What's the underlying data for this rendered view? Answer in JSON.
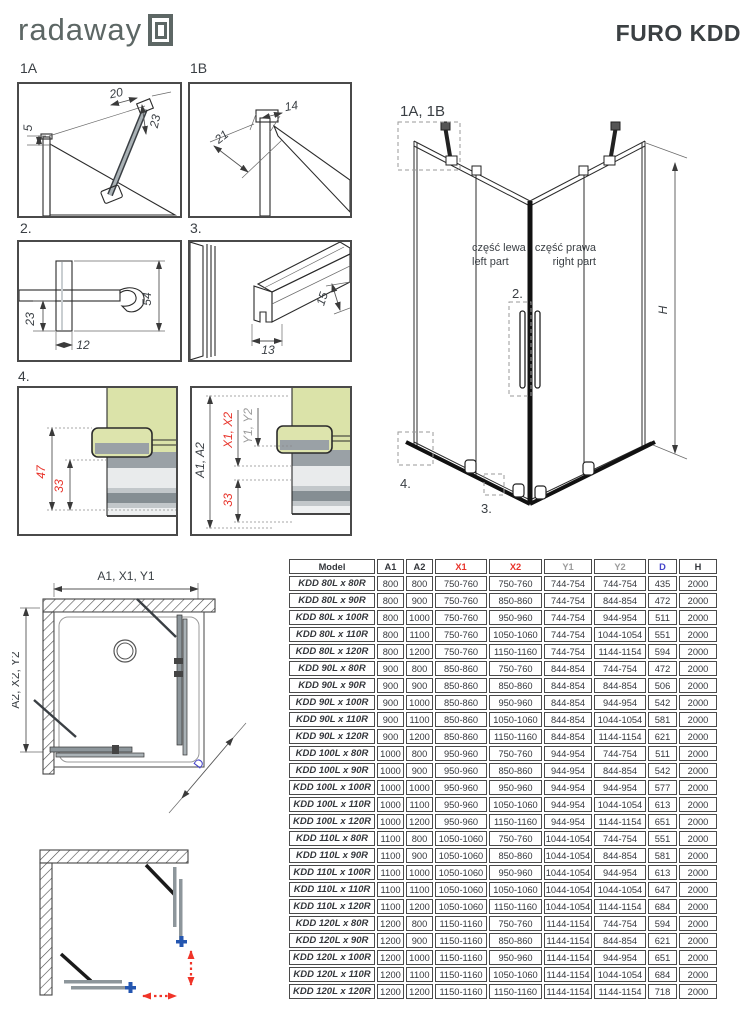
{
  "header": {
    "logo_text": "radaway",
    "title": "FURO KDD"
  },
  "details": {
    "d1a": {
      "label": "1A",
      "dim_top": "20",
      "dim_right": "23",
      "dim_left": "5"
    },
    "d1b": {
      "label": "1B",
      "dim_top": "14",
      "dim_diag": "21"
    },
    "d2": {
      "label": "2.",
      "dim_right": "54",
      "dim_left": "23",
      "dim_bottom": "12"
    },
    "d3": {
      "label": "3.",
      "dim_bottom": "13",
      "dim_right": "15"
    },
    "d4": {
      "label": "4.",
      "dim_outer": "47",
      "dim_inner": "33",
      "dim_a": "A1, A2",
      "dim_x": "X1, X2",
      "dim_y": "Y1, Y2",
      "dim_33": "33"
    }
  },
  "iso": {
    "callout_top": "1A, 1B",
    "callout_handle": "2.",
    "callout_rail": "3.",
    "callout_sill": "4.",
    "part_left_pl": "część lewa",
    "part_left_en": "left part",
    "part_right_pl": "część prawa",
    "part_right_en": "right part",
    "dim_h": "H"
  },
  "plan": {
    "dim_top_a": "A1, ",
    "dim_top_x": "X1, ",
    "dim_top_y": "Y1",
    "dim_left_a": "A2, ",
    "dim_left_x": "X2, ",
    "dim_left_y": "Y2",
    "dim_d": "D"
  },
  "colors": {
    "accent_red": "#e8332a",
    "dim_gray": "#9b9b9b",
    "dim_blue": "#4443c9",
    "text_dark": "#3a3f44",
    "logo_gray": "#5d6765"
  },
  "table": {
    "headers": [
      "Model",
      "A1",
      "A2",
      "X1",
      "X2",
      "Y1",
      "Y2",
      "D",
      "H"
    ],
    "header_colors": [
      "dark",
      "dark",
      "dark",
      "red",
      "red",
      "gray",
      "gray",
      "blue",
      "dark"
    ],
    "rows": [
      [
        "KDD 80L x 80R",
        "800",
        "800",
        "750-760",
        "750-760",
        "744-754",
        "744-754",
        "435",
        "2000"
      ],
      [
        "KDD 80L x 90R",
        "800",
        "900",
        "750-760",
        "850-860",
        "744-754",
        "844-854",
        "472",
        "2000"
      ],
      [
        "KDD 80L x 100R",
        "800",
        "1000",
        "750-760",
        "950-960",
        "744-754",
        "944-954",
        "511",
        "2000"
      ],
      [
        "KDD 80L x 110R",
        "800",
        "1100",
        "750-760",
        "1050-1060",
        "744-754",
        "1044-1054",
        "551",
        "2000"
      ],
      [
        "KDD 80L x 120R",
        "800",
        "1200",
        "750-760",
        "1150-1160",
        "744-754",
        "1144-1154",
        "594",
        "2000"
      ],
      [
        "KDD 90L x 80R",
        "900",
        "800",
        "850-860",
        "750-760",
        "844-854",
        "744-754",
        "472",
        "2000"
      ],
      [
        "KDD 90L x 90R",
        "900",
        "900",
        "850-860",
        "850-860",
        "844-854",
        "844-854",
        "506",
        "2000"
      ],
      [
        "KDD 90L x 100R",
        "900",
        "1000",
        "850-860",
        "950-960",
        "844-854",
        "944-954",
        "542",
        "2000"
      ],
      [
        "KDD 90L x 110R",
        "900",
        "1100",
        "850-860",
        "1050-1060",
        "844-854",
        "1044-1054",
        "581",
        "2000"
      ],
      [
        "KDD 90L x 120R",
        "900",
        "1200",
        "850-860",
        "1150-1160",
        "844-854",
        "1144-1154",
        "621",
        "2000"
      ],
      [
        "KDD 100L x 80R",
        "1000",
        "800",
        "950-960",
        "750-760",
        "944-954",
        "744-754",
        "511",
        "2000"
      ],
      [
        "KDD 100L x 90R",
        "1000",
        "900",
        "950-960",
        "850-860",
        "944-954",
        "844-854",
        "542",
        "2000"
      ],
      [
        "KDD 100L x 100R",
        "1000",
        "1000",
        "950-960",
        "950-960",
        "944-954",
        "944-954",
        "577",
        "2000"
      ],
      [
        "KDD 100L x 110R",
        "1000",
        "1100",
        "950-960",
        "1050-1060",
        "944-954",
        "1044-1054",
        "613",
        "2000"
      ],
      [
        "KDD 100L x 120R",
        "1000",
        "1200",
        "950-960",
        "1150-1160",
        "944-954",
        "1144-1154",
        "651",
        "2000"
      ],
      [
        "KDD 110L x 80R",
        "1100",
        "800",
        "1050-1060",
        "750-760",
        "1044-1054",
        "744-754",
        "551",
        "2000"
      ],
      [
        "KDD 110L x 90R",
        "1100",
        "900",
        "1050-1060",
        "850-860",
        "1044-1054",
        "844-854",
        "581",
        "2000"
      ],
      [
        "KDD 110L x 100R",
        "1100",
        "1000",
        "1050-1060",
        "950-960",
        "1044-1054",
        "944-954",
        "613",
        "2000"
      ],
      [
        "KDD 110L x 110R",
        "1100",
        "1100",
        "1050-1060",
        "1050-1060",
        "1044-1054",
        "1044-1054",
        "647",
        "2000"
      ],
      [
        "KDD 110L x 120R",
        "1100",
        "1200",
        "1050-1060",
        "1150-1160",
        "1044-1054",
        "1144-1154",
        "684",
        "2000"
      ],
      [
        "KDD 120L x 80R",
        "1200",
        "800",
        "1150-1160",
        "750-760",
        "1144-1154",
        "744-754",
        "594",
        "2000"
      ],
      [
        "KDD 120L x 90R",
        "1200",
        "900",
        "1150-1160",
        "850-860",
        "1144-1154",
        "844-854",
        "621",
        "2000"
      ],
      [
        "KDD 120L x 100R",
        "1200",
        "1000",
        "1150-1160",
        "950-960",
        "1144-1154",
        "944-954",
        "651",
        "2000"
      ],
      [
        "KDD 120L x 110R",
        "1200",
        "1100",
        "1150-1160",
        "1050-1060",
        "1144-1154",
        "1044-1054",
        "684",
        "2000"
      ],
      [
        "KDD 120L x 120R",
        "1200",
        "1200",
        "1150-1160",
        "1150-1160",
        "1144-1154",
        "1144-1154",
        "718",
        "2000"
      ]
    ]
  }
}
